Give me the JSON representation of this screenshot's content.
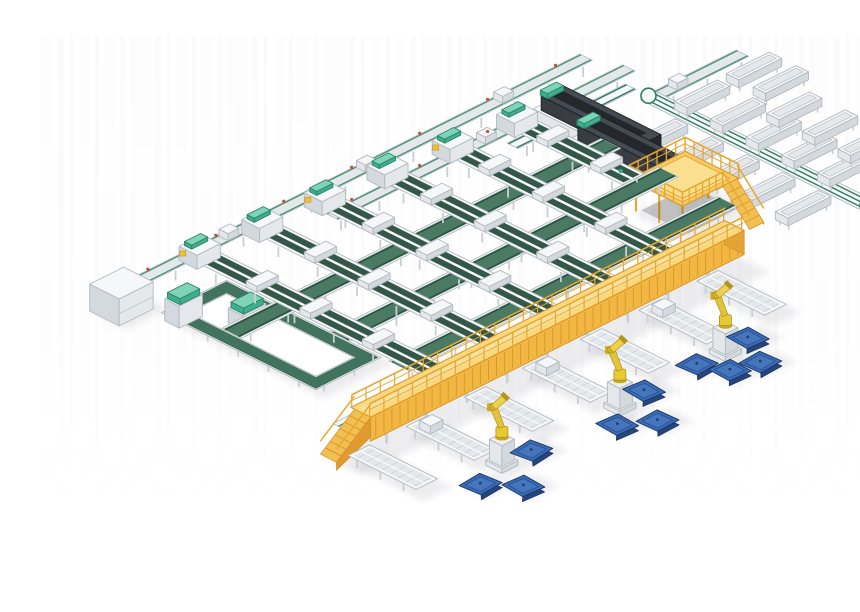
{
  "scene": {
    "title": "Isometric 3D render of an automated parcel sortation and robotic palletizing system with green belt conveyors, yellow gantry, palletizing robots and blue pallets",
    "canvas": {
      "width": 860,
      "height": 580,
      "background": "#ffffff"
    },
    "iso": {
      "ox": 115,
      "oy": 258,
      "k": 0.894,
      "h": 0.447
    },
    "palette": {
      "frame_white": "#f5f7f8",
      "frame_mid": "#e4e8eb",
      "frame_dark": "#d4d9dd",
      "frame_outline": "#b2b9bf",
      "leg_gray": "#c9cfd4",
      "belt_green_dark": "#33584a",
      "belt_lane": "#3c6ala",
      "belt_green": "#4a7a63",
      "belt_edge": "#2d5042",
      "loop_green": "#41735e",
      "line_green": "#3f8f6b",
      "sorter_green": "#2f7d5f",
      "teal": "#3fae8c",
      "teal_light": "#7fd4b8",
      "gantry_top": "#fbd87e",
      "gantry_side": "#f2b743",
      "gantry_dark": "#d89428",
      "rail_yellow": "#e8a72e",
      "stair_side": "#e09a30",
      "platform_top": "#f7ca5e",
      "robot_yellow": "#e8c933",
      "robot_dark": "#a8891c",
      "pedestal": "#eef1f3",
      "pallet_top": "#3a6db6",
      "pallet_rim": "#2c549b",
      "pallet_side": "#25457d",
      "machine_dark": "#383d43",
      "machine_top": "#454b52",
      "machine_deep": "#24282c",
      "marker_red": "#c94d35",
      "marker_yellow": "#f0c030",
      "shadow": "rgba(70,82,92,0.10)",
      "streak": "#8a9096"
    },
    "feed_lines": [
      {
        "name": "infeed-line-main",
        "v": 12,
        "u1": -42,
        "u2": 470,
        "items": 3,
        "dots": true
      },
      {
        "name": "infeed-line-second",
        "v": 48,
        "u1": 150,
        "u2": 482,
        "items": 2,
        "dots": true
      },
      {
        "name": "return-line-topright",
        "v": 95,
        "u1": 470,
        "u2": 562,
        "items": 1,
        "dots": false
      }
    ],
    "cross_belts": [
      {
        "name": "cross-belt-upper",
        "v": 118,
        "u1": -32,
        "u2": 392
      },
      {
        "name": "cross-belt-middle",
        "v": 182,
        "u1": 25,
        "u2": 392
      },
      {
        "name": "cross-belt-lower",
        "v": 248,
        "u1": 25,
        "u2": 392
      }
    ],
    "collect_truss": {
      "name": "collect-line-truss",
      "v": 285,
      "u1": -80,
      "u2": 336
    },
    "spurs": {
      "u": [
        35,
        100,
        165,
        230,
        295,
        360
      ],
      "v_start": [
        25,
        30,
        35,
        40,
        48,
        55
      ],
      "v_end": [
        310,
        310,
        310,
        310,
        310,
        175
      ],
      "width": 20,
      "carriage_v": [
        85,
        145,
        215
      ]
    },
    "sorter": {
      "name": "crossbelt-sorter-loop",
      "u": 462,
      "v1": 90,
      "v2": 335
    },
    "sorter_connector": {
      "name": "sorter-feed-connector",
      "v": 70,
      "u1": 330,
      "u2": 462
    },
    "chute_tables": [
      {
        "u": 425,
        "rows": [
          140,
          180,
          220,
          260,
          300
        ]
      },
      {
        "u": 492,
        "rows": [
          120,
          160,
          200,
          240,
          280
        ]
      },
      {
        "u": 530,
        "rows": [
          185,
          225,
          265
        ]
      },
      {
        "u": 552,
        "rows": [
          118,
          148
        ]
      }
    ],
    "dark_machines": [
      {
        "name": "telescopic-loader-1",
        "u1": 385,
        "v1": 38,
        "u2": 415,
        "v2": 160
      },
      {
        "name": "telescopic-loader-2",
        "u1": 372,
        "v1": 92,
        "u2": 402,
        "v2": 214
      }
    ],
    "platform": {
      "name": "work-platform",
      "u1": 335,
      "u2": 398,
      "v1": 195,
      "v2": 255,
      "height": 32
    },
    "loop": {
      "name": "tote-loop-conveyor",
      "u1": -45,
      "u2": 25,
      "v1": 55,
      "v2": 225,
      "band": 13,
      "cabinets": [
        {
          "u": -45,
          "v": 62
        },
        {
          "u": -20,
          "v": 108
        }
      ]
    },
    "box_machine": {
      "name": "infeed-machine-cabinet",
      "u1": -78,
      "v1": 5,
      "u2": -40,
      "v2": 38,
      "height": 27
    },
    "gantry": {
      "name": "palletizing-gantry",
      "u1": -80,
      "u2": 338,
      "v1": 299,
      "v2": 321,
      "height": 36,
      "stair_u": -118,
      "leg_step": 45
    },
    "floor_chutes": {
      "u": [
        -92,
        -27,
        38,
        103,
        168,
        233,
        298
      ],
      "v1": 320,
      "v2": 396,
      "width": 24
    },
    "robots": [
      {
        "name": "palletizing-robot-1",
        "u": -20,
        "v": 408
      },
      {
        "name": "palletizing-robot-2",
        "u": 110,
        "v": 410
      },
      {
        "name": "palletizing-robot-3",
        "u": 230,
        "v": 408
      }
    ],
    "pallets": [
      {
        "u": -53,
        "v": 417,
        "r": -4
      },
      {
        "u": -31,
        "v": 443,
        "r": 3
      },
      {
        "u": 13,
        "v": 408,
        "r": -6
      },
      {
        "u": 90,
        "v": 427,
        "r": 3
      },
      {
        "u": 117,
        "v": 445,
        "r": -2
      },
      {
        "u": 143,
        "v": 404,
        "r": 4
      },
      {
        "u": 202,
        "v": 404,
        "r": -3
      },
      {
        "u": 214,
        "v": 429,
        "r": 2
      },
      {
        "u": 240,
        "v": 437,
        "r": -3
      },
      {
        "u": 260,
        "v": 403,
        "r": 3
      }
    ],
    "streaks": [
      {
        "x": 0,
        "w": 14,
        "o": 0.016
      },
      {
        "x": 18,
        "w": 6,
        "o": 0.03
      },
      {
        "x": 30,
        "w": 3,
        "o": 0.045
      },
      {
        "x": 40,
        "w": 10,
        "o": 0.014
      },
      {
        "x": 55,
        "w": 4,
        "o": 0.038
      },
      {
        "x": 63,
        "w": 12,
        "o": 0.02
      },
      {
        "x": 80,
        "w": 5,
        "o": 0.034
      },
      {
        "x": 90,
        "w": 6,
        "o": 0.024
      }
    ]
  }
}
